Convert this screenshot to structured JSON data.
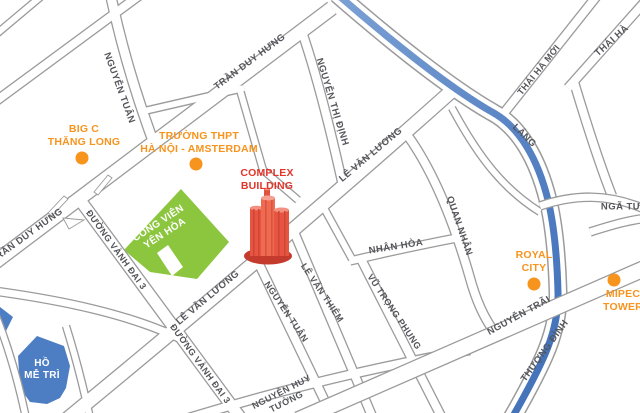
{
  "colors": {
    "background": "#ffffff",
    "road_casing": "#9b9b9b",
    "road_fill": "#ffffff",
    "water": "#4d7ec3",
    "park": "#8cc63f",
    "poi_orange": "#f7941e",
    "complex_red": "#e2342a",
    "building_light": "#f06a52",
    "building_mid": "#e85442",
    "building_dark": "#c43b2d",
    "street_text": "#54555a",
    "label_white": "#ffffff"
  },
  "complex": {
    "lines": [
      "COMPLEX",
      "BUILDING"
    ]
  },
  "park": {
    "lines": [
      "CÔNG VIÊN",
      "YÊN HÒA"
    ]
  },
  "lake": {
    "lines": [
      "HỒ",
      "MỄ TRÌ"
    ]
  },
  "streets": [
    {
      "text": "NGUYỄN TUÂN",
      "x": 119,
      "y": 88,
      "rot": 70,
      "size": 9.5
    },
    {
      "text": "TRẦN DUY HƯNG",
      "x": 250,
      "y": 62,
      "rot": -37,
      "size": 9.5
    },
    {
      "text": "TRẦN DUY HƯNG",
      "x": 27,
      "y": 236,
      "rot": -36,
      "size": 9.5
    },
    {
      "text": "NGUYỄN THỊ ĐỊNH",
      "x": 332,
      "y": 102,
      "rot": 73,
      "size": 9.5
    },
    {
      "text": "LÊ VĂN LƯƠNG",
      "x": 371,
      "y": 155,
      "rot": -40,
      "size": 9.5
    },
    {
      "text": "LÊ VĂN LƯƠNG",
      "x": 208,
      "y": 298,
      "rot": -40,
      "size": 9.5
    },
    {
      "text": "ĐƯỜNG VÀNH ĐAI 3",
      "x": 116,
      "y": 250,
      "rot": 54,
      "size": 9
    },
    {
      "text": "ĐƯỜNG VÀNH ĐAI 3",
      "x": 200,
      "y": 364,
      "rot": 54,
      "size": 9
    },
    {
      "text": "NGUYỄN TUÂN",
      "x": 286,
      "y": 312,
      "rot": 56,
      "size": 9
    },
    {
      "text": "LÊ VĂN THIÊM",
      "x": 322,
      "y": 293,
      "rot": 56,
      "size": 9
    },
    {
      "lines": [
        "NGUYỄN HUY",
        "TƯỞNG"
      ],
      "x": 284,
      "y": 397,
      "rot": -27,
      "size": 9
    },
    {
      "text": "NHÂN HÒA",
      "x": 396,
      "y": 247,
      "rot": -9,
      "size": 9.5
    },
    {
      "text": "VŨ TRỌNG PHỤNG",
      "x": 394,
      "y": 312,
      "rot": 56,
      "size": 9
    },
    {
      "text": "QUAN NHÂN",
      "x": 459,
      "y": 226,
      "rot": 71,
      "size": 9.5
    },
    {
      "text": "LÁNG",
      "x": 524,
      "y": 136,
      "rot": 44,
      "size": 9.5
    },
    {
      "text": "THÁI HÀ MỚI",
      "x": 539,
      "y": 70,
      "rot": -51,
      "size": 9
    },
    {
      "text": "THÁI HÀ",
      "x": 612,
      "y": 41,
      "rot": -42,
      "size": 9.5
    },
    {
      "text": "NGÃ TƯ",
      "x": 621,
      "y": 207,
      "rot": 0,
      "size": 9.5
    },
    {
      "text": "NGUYỄN TRÃI",
      "x": 519,
      "y": 316,
      "rot": -29,
      "size": 9.5
    },
    {
      "text": "THƯỢNG ĐÌNH",
      "x": 545,
      "y": 351,
      "rot": -54,
      "size": 9.5
    }
  ],
  "pois": [
    {
      "id": "big-c-thang-long",
      "lines": [
        "BIG C",
        "THĂNG LONG"
      ],
      "label_x": 84,
      "label_y": 136,
      "dot_x": 82,
      "dot_y": 158,
      "dot_r": 6.5
    },
    {
      "id": "truong-thpt-ha-noi-amsterdam",
      "lines": [
        "TRƯỜNG THPT",
        "HÀ NỘI - AMSTERDAM"
      ],
      "label_x": 199,
      "label_y": 143,
      "dot_x": 196,
      "dot_y": 164,
      "dot_r": 6.5
    },
    {
      "id": "royal-city",
      "lines": [
        "ROYAL",
        "CITY"
      ],
      "label_x": 534,
      "label_y": 262,
      "dot_x": 534,
      "dot_y": 284,
      "dot_r": 6.5
    },
    {
      "id": "mipec-tower",
      "lines": [
        "MIPEC",
        "TOWER"
      ],
      "label_x": 623,
      "label_y": 301,
      "dot_x": 614,
      "dot_y": 280,
      "dot_r": 6.5
    }
  ],
  "geometry": {
    "shapes_under": [
      {
        "name": "park-yen-hoa",
        "fill": "park",
        "d": "M181,189 L229,242 L197,279 L150,272 L124,250 Z"
      },
      {
        "name": "park-notch",
        "fill": "#ffffff",
        "d": "M168,245 L183,267 L172,276 L157,253 Z"
      },
      {
        "name": "me-tri-lake",
        "fill": "water",
        "d": "M37,336 L18,356 L20,388 L30,402 L47,404 L60,398 L66,388 L70,366 L64,346 Z"
      },
      {
        "name": "water-wedge",
        "fill": "water",
        "d": "M0,307 L13,317 L6,331 L0,331 Z"
      }
    ],
    "roads_under": [
      {
        "id": "corner-nw",
        "d": "M44,-6 L-6,36",
        "w": 6
      },
      {
        "id": "pham-hung",
        "d": "M144,-8 L-8,104",
        "w": 8
      },
      {
        "id": "block-school-north",
        "d": "M140,112 L244,88",
        "w": 6
      },
      {
        "id": "block-school-east",
        "d": "M240,90 L263,170",
        "w": 6
      },
      {
        "id": "block-mid",
        "d": "M263,170 L298,200",
        "w": 6
      },
      {
        "id": "me-tri-north",
        "d": "M-6,291 C60,300 130,314 183,340",
        "w": 7
      },
      {
        "id": "me-tri-west",
        "d": "M-4,316 C8,346 18,380 26,418",
        "w": 6
      },
      {
        "id": "lake-east",
        "d": "M66,326 C76,358 84,390 90,418",
        "w": 6
      },
      {
        "id": "nguyen-tuan-top",
        "d": "M110,-8 C122,50 138,100 152,138",
        "w": 9
      },
      {
        "id": "nguyen-thi-dinh",
        "d": "M301,29 C316,72 331,132 343,186",
        "w": 8
      },
      {
        "id": "nhan-hoa-connector",
        "d": "M324,208 L352,259",
        "w": 6
      },
      {
        "id": "nhan-hoa",
        "d": "M350,261 C388,252 425,244 462,237",
        "w": 7
      },
      {
        "id": "quan-nhan",
        "d": "M408,136 C438,178 458,235 472,285 C479,308 487,322 497,336",
        "w": 8
      },
      {
        "id": "vu-trong-phung",
        "d": "M361,259 L442,418",
        "w": 8
      },
      {
        "id": "le-van-thiem",
        "d": "M294,232 L372,416",
        "w": 8
      },
      {
        "id": "nguyen-tuan-lower",
        "d": "M258,262 L332,416",
        "w": 8
      },
      {
        "id": "nguyen-huy-tuong",
        "d": "M182,420 C280,390 370,368 470,350",
        "w": 8
      },
      {
        "id": "riverside-connector",
        "d": "M452,108 C480,160 505,190 540,212",
        "w": 6
      },
      {
        "id": "thai-ha-moi",
        "d": "M500,118 L600,-8",
        "w": 8
      },
      {
        "id": "thai-ha",
        "d": "M568,88 L650,-4",
        "w": 8
      },
      {
        "id": "tay-son",
        "d": "M574,82 C586,122 598,160 612,196",
        "w": 8
      },
      {
        "id": "vanh-dai-3",
        "d": "M77,196 L242,420",
        "w": 11
      },
      {
        "id": "tran-duy-hung",
        "d": "M332,8 L-10,266",
        "w": 13
      },
      {
        "id": "le-van-luong",
        "d": "M66,420 C190,318 330,200 455,88",
        "w": 13
      }
    ],
    "islands": [
      {
        "name": "ramp-island-1",
        "d": "M48,213 L64,196 L68,199 L52,216 Z"
      },
      {
        "name": "ramp-island-2",
        "d": "M94,192 L108,175 L112,178 L98,195 Z"
      },
      {
        "name": "ramp-island-3",
        "d": "M63,218 L84,220 L69,229 Z"
      }
    ],
    "river": {
      "d": "M337,-6 C390,40 450,88 492,112 C520,127 538,160 548,200 C554,225 557,255 558,292 C559,330 545,360 512,418",
      "casing_w": 19,
      "road_w": 16,
      "water_w": 7
    },
    "roads_over": [
      {
        "id": "nga-tu-flare",
        "d": "M540,206 C575,194 608,194 642,208",
        "w": 7
      },
      {
        "id": "truong-chinh",
        "d": "M590,232 C615,224 630,220 648,218",
        "w": 7
      },
      {
        "id": "nguyen-trai",
        "d": "M650,266 C540,315 430,362 298,420",
        "w": 15
      }
    ]
  }
}
